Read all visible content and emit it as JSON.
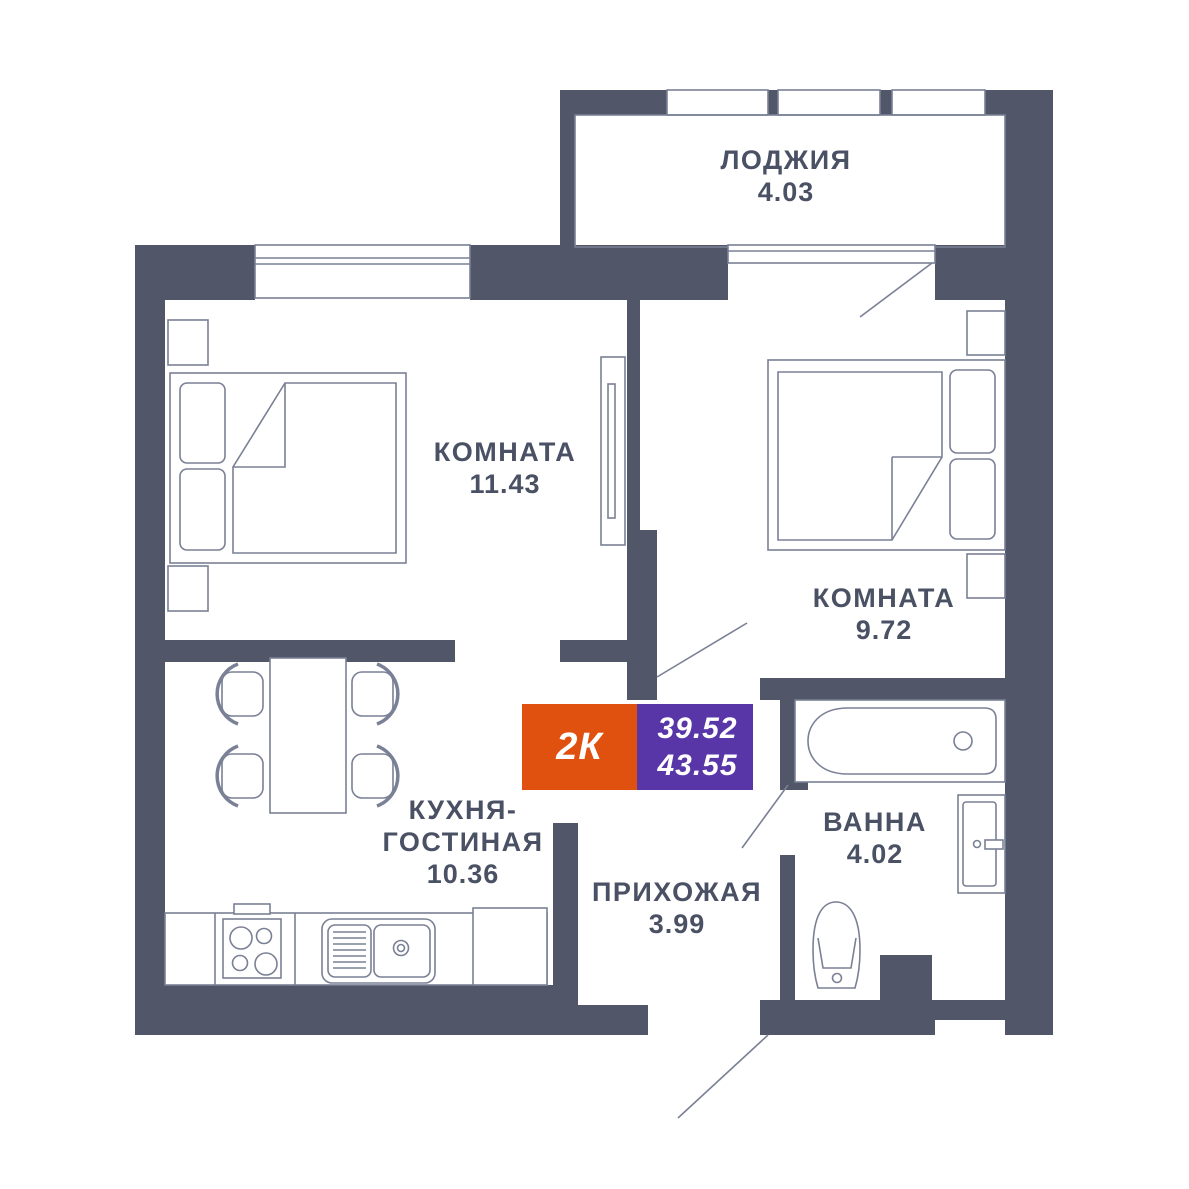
{
  "floor_plan": {
    "badge": {
      "apartment_type": "2К",
      "living_area": "39.52",
      "total_area": "43.55"
    },
    "rooms": [
      {
        "name": "ЛОДЖИЯ",
        "area": "4.03"
      },
      {
        "name": "КОМНАТА",
        "area": "11.43"
      },
      {
        "name": "КОМНАТА",
        "area": "9.72"
      },
      {
        "name": "КУХНЯ-ГОСТИНАЯ",
        "area": "10.36"
      },
      {
        "name": "ПРИХОЖАЯ",
        "area": "3.99"
      },
      {
        "name": "ВАННА",
        "area": "4.02"
      }
    ],
    "colors": {
      "wall": "#515769",
      "outline": "#7A8095",
      "text": "#4A5164",
      "badge_orange": "#E0500F",
      "badge_purple": "#5936A8",
      "background": "#FFFFFF"
    }
  }
}
